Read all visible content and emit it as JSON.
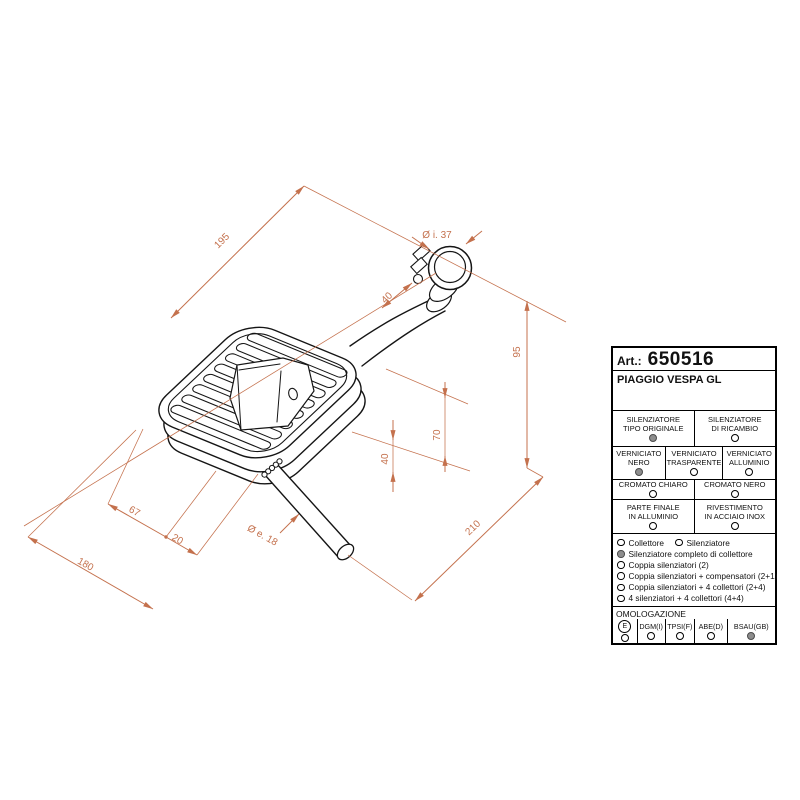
{
  "drawing": {
    "dim_color": "#c4714d",
    "dimensions": {
      "top_length": "195",
      "inlet_diameter": "Ø i. 37",
      "inlet_offset": "40",
      "inlet_height": "95",
      "mid_height": "70",
      "low_height": "40",
      "front_length": "67",
      "outlet_offset": "20",
      "outlet_diameter": "Ø e. 18",
      "bottom_length": "180",
      "right_length": "210"
    }
  },
  "table": {
    "art_label": "Art.:",
    "art_number": "650516",
    "model": "PIAGGIO VESPA GL",
    "type_options": [
      {
        "line1": "SILENZIATORE",
        "line2": "TIPO ORIGINALE",
        "filled": true
      },
      {
        "line1": "SILENZIATORE",
        "line2": "DI RICAMBIO",
        "filled": false
      }
    ],
    "paint_options": [
      {
        "line1": "VERNICIATO",
        "line2": "NERO",
        "filled": true
      },
      {
        "line1": "VERNICIATO",
        "line2": "TRASPARENTE",
        "filled": false
      },
      {
        "line1": "VERNICIATO",
        "line2": "ALLUMINIO",
        "filled": false
      }
    ],
    "chrome_options": [
      {
        "line1": "CROMATO CHIARO",
        "filled": false
      },
      {
        "line1": "CROMATO NERO",
        "filled": false
      }
    ],
    "material_options": [
      {
        "line1": "PARTE FINALE",
        "line2": "IN ALLUMINIO",
        "filled": false
      },
      {
        "line1": "RIVESTIMENTO",
        "line2": "IN ACCIAIO INOX",
        "filled": false
      }
    ],
    "kit_options": [
      {
        "label": "Collettore",
        "filled": false
      },
      {
        "label": "Silenziatore",
        "filled": false
      },
      {
        "label": "Silenziatore completo di collettore",
        "filled": true
      },
      {
        "label": "Coppia silenziatori (2)",
        "filled": false
      },
      {
        "label": "Coppia silenziatori + compensatori (2+1)",
        "filled": false
      },
      {
        "label": "Coppia silenziatori + 4 collettori (2+4)",
        "filled": false
      },
      {
        "label": "4 silenziatori + 4 collettori (4+4)",
        "filled": false
      }
    ],
    "homologation": {
      "title": "OMOLOGAZIONE",
      "entries": [
        {
          "label": "E",
          "circled": true,
          "filled": false
        },
        {
          "label": "DGM(I)",
          "circled": false,
          "filled": false
        },
        {
          "label": "TPSI(F)",
          "circled": false,
          "filled": false
        },
        {
          "label": "ABE(D)",
          "circled": false,
          "filled": false
        },
        {
          "label": "BSAU(GB)",
          "circled": false,
          "filled": true
        }
      ]
    }
  }
}
